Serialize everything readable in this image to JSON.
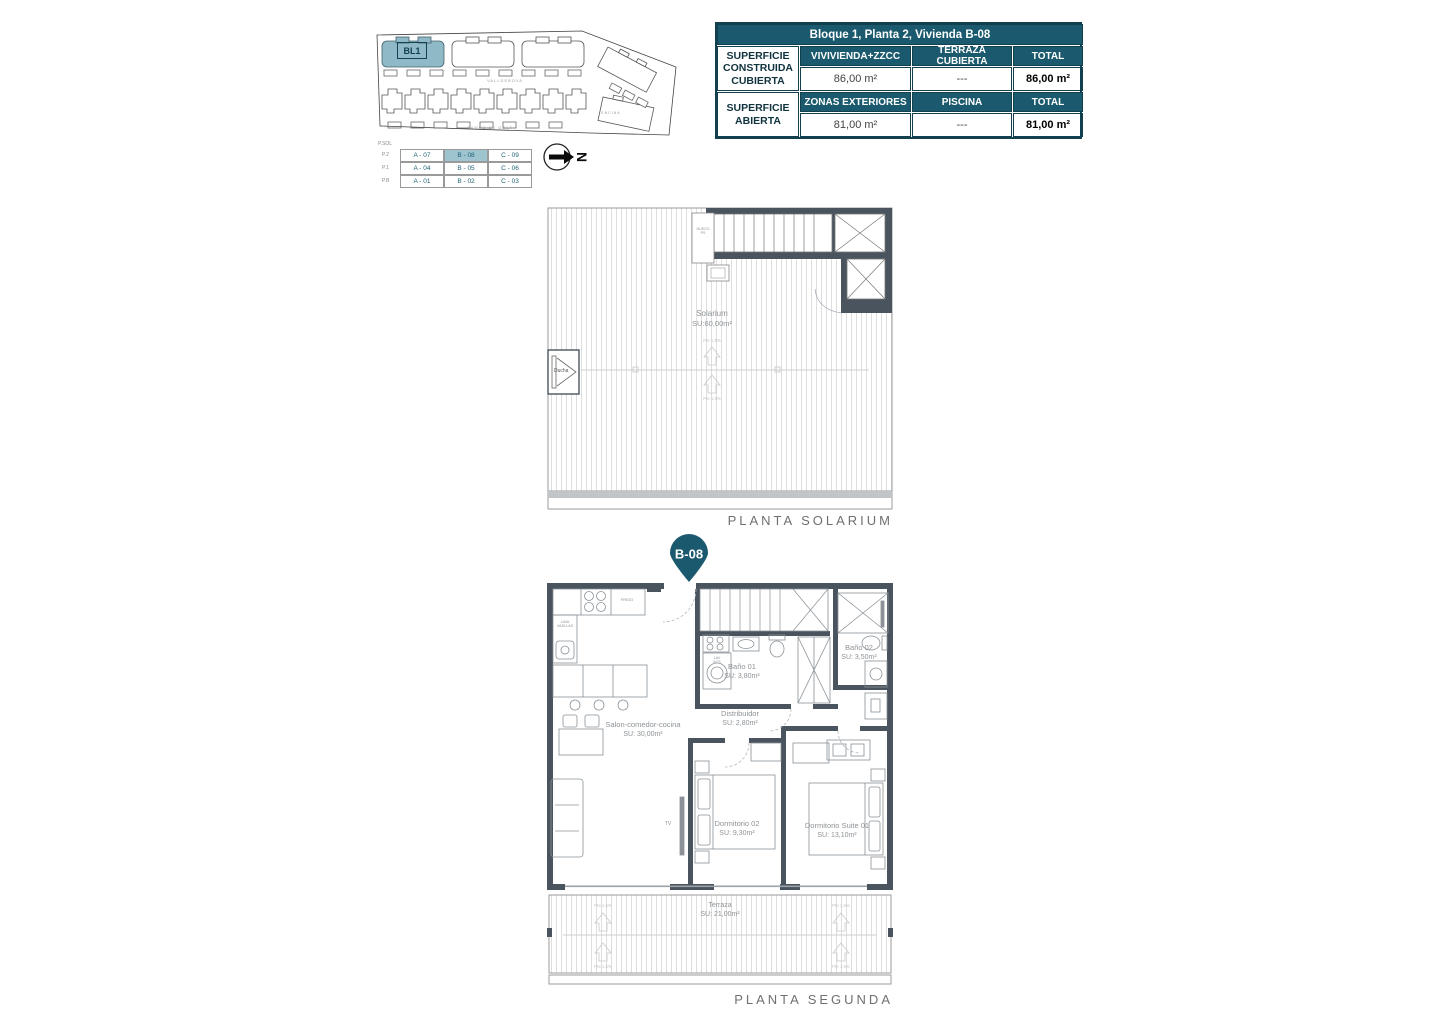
{
  "colors": {
    "teal": "#1b5a6e",
    "teal_light": "#8fb9c6",
    "wall": "#4a545e",
    "highlight_cell": "#9ec5cf"
  },
  "site_plan": {
    "block_label": "BL1",
    "street_top": "VALLDEBOVA",
    "street_bottom": "CAMPO DE GOLF",
    "street_right": "ENCINA"
  },
  "unit_matrix": {
    "corner_label": "P.SOL",
    "levels": [
      "P.2",
      "P.1",
      "P.B"
    ],
    "rows": [
      [
        "A - 07",
        "B - 08",
        "C - 09"
      ],
      [
        "A - 04",
        "B - 05",
        "C - 06"
      ],
      [
        "A - 01",
        "B - 02",
        "C - 03"
      ]
    ],
    "highlighted_unit": "B - 08"
  },
  "compass": {
    "letter": "N"
  },
  "summary_table": {
    "title": "Bloque 1, Planta 2, Vivienda B-08",
    "row_groups": [
      {
        "label": "SUPERFICIE CONSTRUIDA CUBIERTA",
        "columns": [
          "VIVIVIENDA+ZZCC",
          "TERRAZA CUBIERTA",
          "TOTAL"
        ],
        "values": [
          "86,00 m²",
          "---",
          "86,00 m²"
        ]
      },
      {
        "label": "SUPERFICIE ABIERTA",
        "columns": [
          "ZONAS EXTERIORES",
          "PISCINA",
          "TOTAL"
        ],
        "values": [
          "81,00 m²",
          "---",
          "81,00 m²"
        ]
      }
    ]
  },
  "solarium_plan": {
    "caption": "PLANTA SOLARIUM",
    "room": "Solarium",
    "area": "SU:60,00m²",
    "shower": "Ducha",
    "shaft": "HUECO\nPS",
    "slope": "Pte 1,5%"
  },
  "marker": {
    "label": "B-08"
  },
  "second_plan": {
    "caption": "PLANTA SEGUNDA",
    "rooms": {
      "salon": {
        "name": "Salon-comedor-cocina",
        "area": "SU: 30,00m²"
      },
      "distribuidor": {
        "name": "Distribuidor",
        "area": "SU: 2,80m²"
      },
      "bano1": {
        "name": "Baño 01",
        "area": "SU: 3,80m²"
      },
      "bano2": {
        "name": "Baño 02",
        "area": "SU: 3,50m²"
      },
      "dorm2": {
        "name": "Dormitorio 02",
        "area": "SU: 9,30m²"
      },
      "suite": {
        "name": "Dormitorio Suite 01",
        "area": "SU: 13,10m²"
      },
      "terraza": {
        "name": "Terraza",
        "area": "SU: 21,00m²"
      }
    },
    "fixtures": {
      "frigo": "FRIGO",
      "lavavajillas": "LAVA\nVAJILLAS",
      "lav_acs": "LAV\nACS",
      "tv": "TV"
    },
    "slope": "Pte 1,5%"
  }
}
